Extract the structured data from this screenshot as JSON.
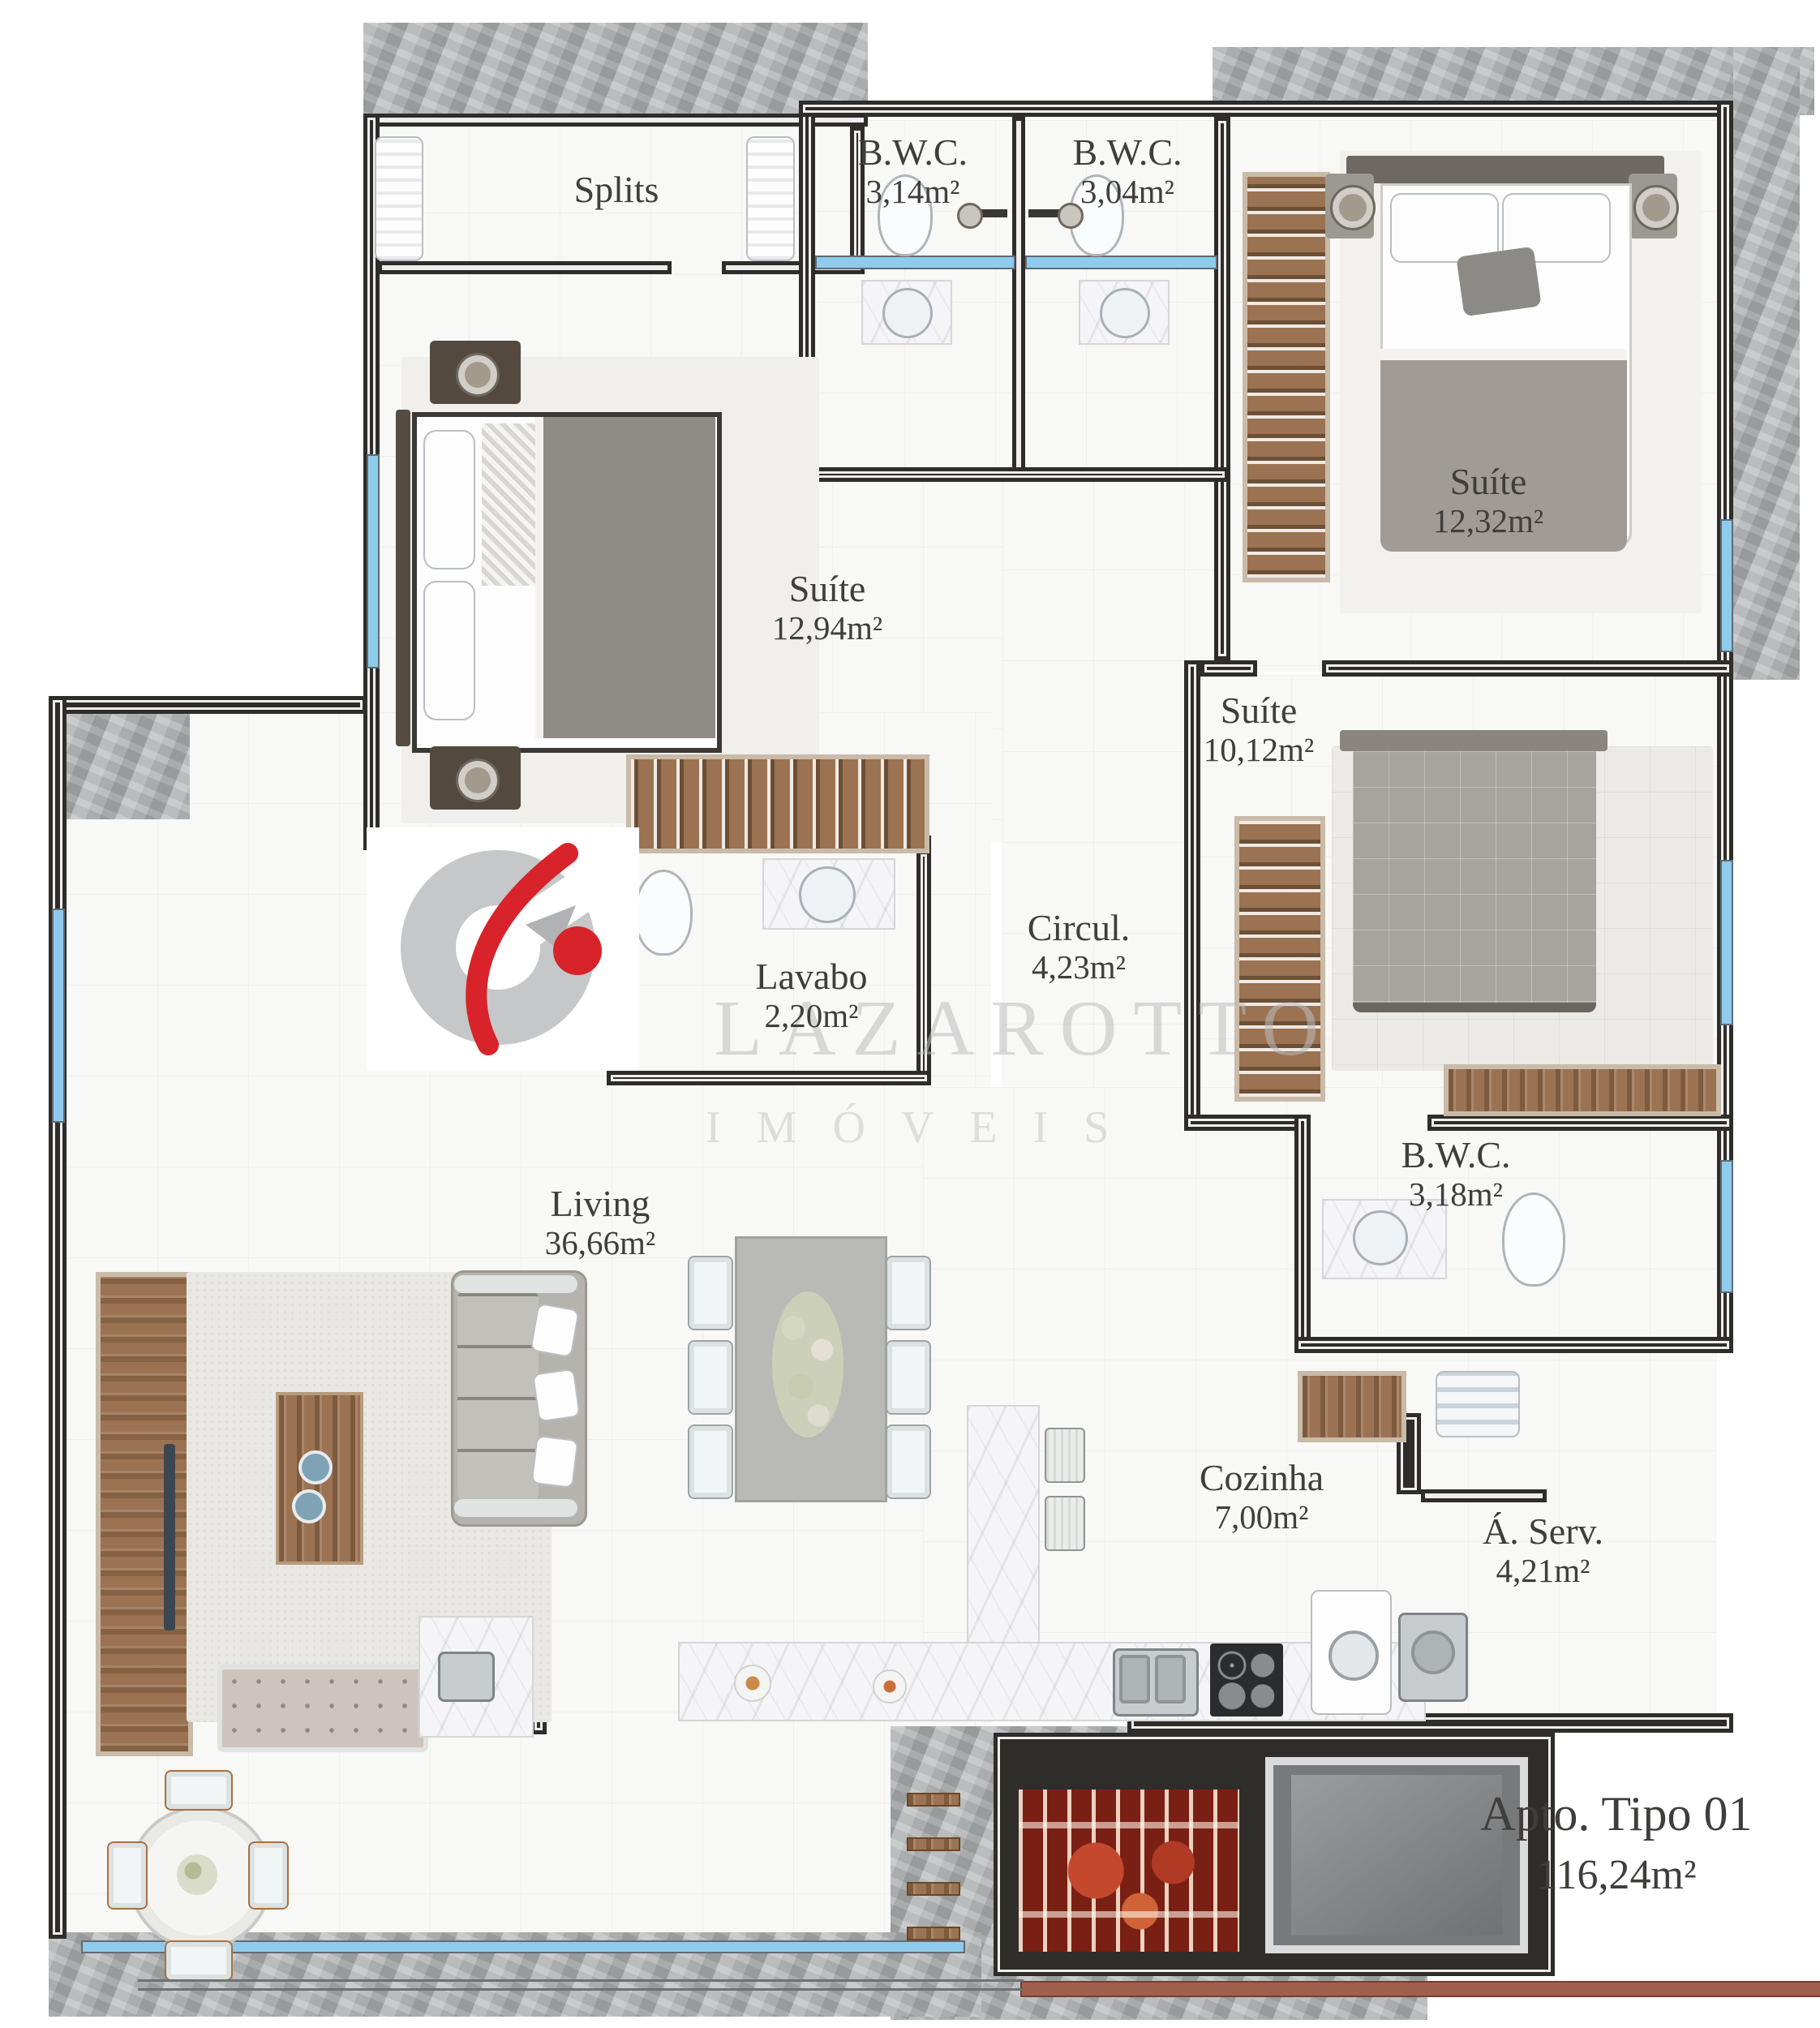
{
  "title": {
    "name": "Apto. Tipo 01",
    "area": "116,24m²"
  },
  "watermark": {
    "brand": "LAZAROTTO",
    "division": "IMÓVEIS"
  },
  "rooms": {
    "splits": {
      "name": "Splits"
    },
    "bwc_top_left": {
      "name": "B.W.C.",
      "area": "3,14m²"
    },
    "bwc_top_right": {
      "name": "B.W.C.",
      "area": "3,04m²"
    },
    "suite_right": {
      "name": "Suíte",
      "area": "12,32m²"
    },
    "suite_left": {
      "name": "Suíte",
      "area": "12,94m²"
    },
    "suite_mid": {
      "name": "Suíte",
      "area": "10,12m²"
    },
    "lavabo": {
      "name": "Lavabo",
      "area": "2,20m²"
    },
    "circulacao": {
      "name": "Circul.",
      "area": "4,23m²"
    },
    "bwc_mid": {
      "name": "B.W.C.",
      "area": "3,18m²"
    },
    "living": {
      "name": "Living",
      "area": "36,66m²"
    },
    "cozinha": {
      "name": "Cozinha",
      "area": "7,00m²"
    },
    "area_servico": {
      "name": "Á. Serv.",
      "area": "4,21m²"
    }
  },
  "colors": {
    "wall": "#2f2d2a",
    "window_glass": "#8ecbed",
    "wood": "#9b7352",
    "concrete": "#b4b7b8",
    "logo_gray": "#c5c7c9",
    "logo_red": "#d8232a",
    "handrail": "#a35f4d"
  }
}
